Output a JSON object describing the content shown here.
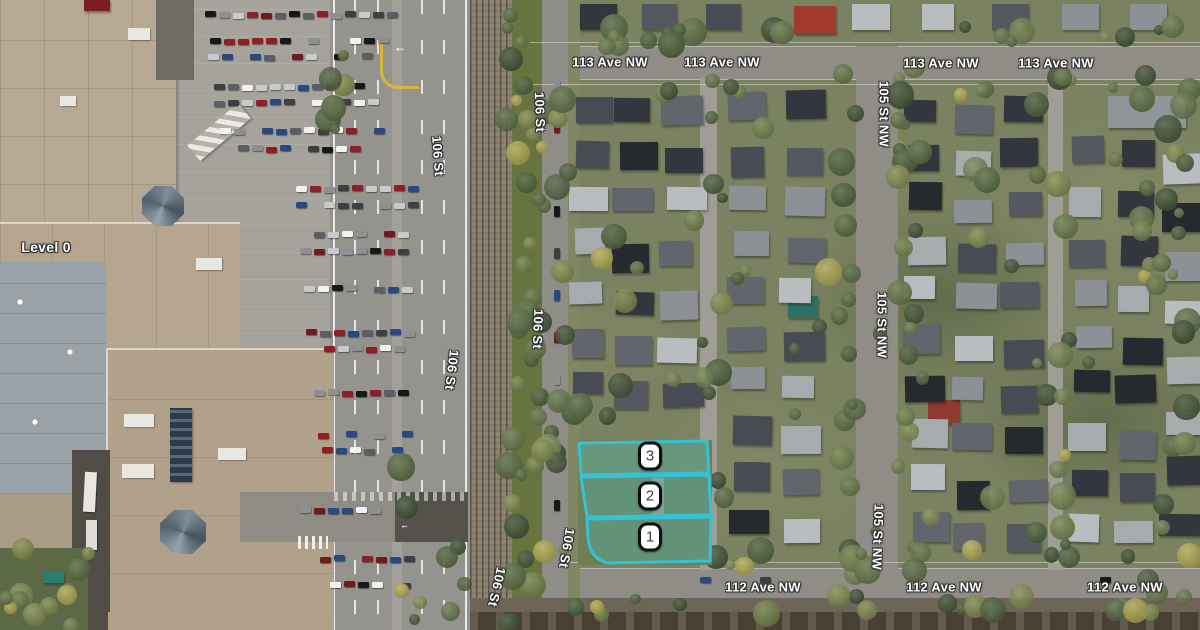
{
  "map": {
    "labels": [
      {
        "name": "street-label-113-ave-1",
        "text": "113 Ave NW",
        "x": 610,
        "y": 62,
        "rot": 0
      },
      {
        "name": "street-label-113-ave-2",
        "text": "113 Ave NW",
        "x": 722,
        "y": 62,
        "rot": 0
      },
      {
        "name": "street-label-113-ave-3",
        "text": "113 Ave NW",
        "x": 941,
        "y": 63,
        "rot": 0
      },
      {
        "name": "street-label-113-ave-4",
        "text": "113 Ave NW",
        "x": 1056,
        "y": 63,
        "rot": 0
      },
      {
        "name": "street-label-112-ave-1",
        "text": "112 Ave NW",
        "x": 763,
        "y": 587,
        "rot": 0
      },
      {
        "name": "street-label-112-ave-2",
        "text": "112 Ave NW",
        "x": 944,
        "y": 587,
        "rot": 0
      },
      {
        "name": "street-label-112-ave-3",
        "text": "112 Ave NW",
        "x": 1125,
        "y": 587,
        "rot": 0
      },
      {
        "name": "street-label-105-st-1",
        "text": "105 St NW",
        "x": 884,
        "y": 114,
        "rot": 90
      },
      {
        "name": "street-label-105-st-2",
        "text": "105 St NW",
        "x": 882,
        "y": 325,
        "rot": 90
      },
      {
        "name": "street-label-105-st-3",
        "text": "105 St NW",
        "x": 878,
        "y": 537,
        "rot": 92
      },
      {
        "name": "street-label-106-st-1",
        "text": "106 St",
        "x": 438,
        "y": 156,
        "rot": 86
      },
      {
        "name": "street-label-106-st-2",
        "text": "106 St",
        "x": 540,
        "y": 112,
        "rot": 88
      },
      {
        "name": "street-label-106-st-3",
        "text": "106 St",
        "x": 538,
        "y": 329,
        "rot": 92
      },
      {
        "name": "street-label-106-st-4",
        "text": "106 St",
        "x": 452,
        "y": 370,
        "rot": 97
      },
      {
        "name": "street-label-106-st-5",
        "text": "106 St",
        "x": 497,
        "y": 587,
        "rot": 103
      },
      {
        "name": "street-label-106-st-6",
        "text": "106 St",
        "x": 567,
        "y": 548,
        "rot": 100
      },
      {
        "name": "level-label",
        "text": "Level 0",
        "x": 46,
        "y": 247,
        "rot": 0,
        "size": 14
      }
    ],
    "markers": [
      {
        "label": "3",
        "x": 650,
        "y": 456
      },
      {
        "label": "2",
        "x": 650,
        "y": 496
      },
      {
        "label": "1",
        "x": 650,
        "y": 537
      }
    ],
    "parcels": {
      "outline_color": "#35c1d6",
      "fill_color": "rgba(62,199,216,0.27)",
      "shapes": [
        {
          "id": "parcel-3",
          "path": "M579,443 L707,441 L709,473 L581,475 Z"
        },
        {
          "id": "parcel-2",
          "path": "M581,477 L709,475 L711,515 L587,517 Z"
        },
        {
          "id": "parcel-1",
          "path": "M587,519 L711,517 L710,561 L608,563 Q590,559 588,538 Z"
        }
      ]
    },
    "palette": {
      "residential_base": "#7b8261",
      "road": "#95938d",
      "avenue": "#8f8d86",
      "alley": "#a09d95",
      "rail_bed": "#8c8372",
      "parking": "#a6a39c",
      "mall_roof_tan": "#b3a28b",
      "mall_roof_gray": "#9aa2a7",
      "parcel_lawn": "#6f7e55",
      "car_colors": [
        "#f2f2f0",
        "#17181a",
        "#8e8f93",
        "#c9cacc",
        "#5b5e64",
        "#8c1f28",
        "#6e1a1f",
        "#2a4a7f",
        "#3d3f45"
      ],
      "roof_colors": [
        "#33363c",
        "#484b51",
        "#62656b",
        "#8d9094",
        "#a6abae",
        "#babdbf",
        "#55585e",
        "#26292e"
      ],
      "tree_colors": [
        "#3d4f30",
        "#495d37",
        "#56693e",
        "#637545",
        "#6f8048",
        "#7f8a4b"
      ],
      "tree_accent": "#b0a94f"
    },
    "features": [
      {
        "name": "red-roof-house-north",
        "x": 794,
        "y": 6,
        "w": 42,
        "h": 28,
        "color": "#a03a2e"
      },
      {
        "name": "red-roof-house-mid",
        "x": 928,
        "y": 400,
        "w": 32,
        "h": 24,
        "color": "#8e3a31"
      },
      {
        "name": "teal-roof-house",
        "x": 788,
        "y": 296,
        "w": 30,
        "h": 22,
        "color": "#2f6e63"
      },
      {
        "name": "long-building",
        "x": 1108,
        "y": 96,
        "w": 78,
        "h": 32,
        "color": "#8f9598"
      },
      {
        "name": "parcel-house-2",
        "x": 594,
        "y": 478,
        "w": 56,
        "h": 36,
        "color": "#335052"
      },
      {
        "name": "parcel-house-1",
        "x": 598,
        "y": 521,
        "w": 60,
        "h": 32,
        "color": "#3c5a51"
      },
      {
        "name": "red-sign",
        "x": 84,
        "y": 0,
        "w": 26,
        "h": 11,
        "color": "#7b1f22"
      },
      {
        "name": "dumpster",
        "x": 44,
        "y": 572,
        "w": 20,
        "h": 11,
        "color": "#2e7d72"
      }
    ]
  }
}
